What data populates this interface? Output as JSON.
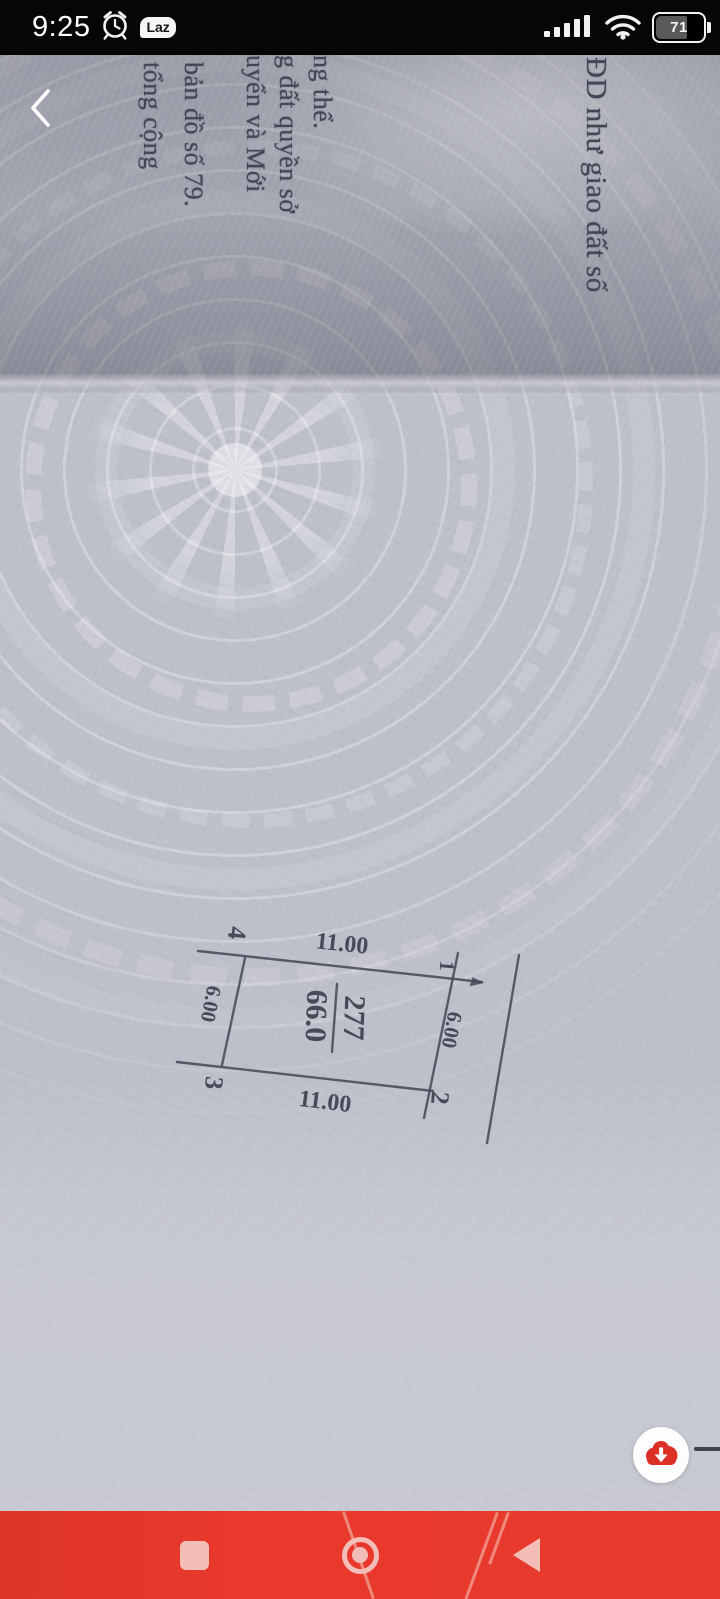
{
  "status_bar": {
    "time": "9:25",
    "laz_label": "Laz",
    "battery_percent": "71",
    "icons": [
      "alarm-icon",
      "lazada-notification-icon",
      "signal-icon",
      "wifi-icon",
      "battery-indicator"
    ]
  },
  "viewer": {
    "back_icon": "chevron-left",
    "download_icon": "cloud-download"
  },
  "document": {
    "lines": [
      "ĐD như giao đất số",
      "ng thể.",
      "g đất quyền sở",
      "uyển và Mới",
      "bản đồ số 79.",
      "tổng cộng"
    ],
    "parcel": {
      "number": "277",
      "area": "66.0",
      "top_length": "11.00",
      "bottom_length": "11.00",
      "left_length": "6.00",
      "right_length": "6.00",
      "v1": "1",
      "v2": "2",
      "v3": "3",
      "v4": "4"
    }
  },
  "nav_bar": {
    "recents_icon": "square",
    "home_icon": "circle",
    "back_icon": "triangle-left"
  },
  "colors": {
    "status_bar_bg": "#060607",
    "paper": "#bdbfca",
    "ink": "#434656",
    "nav_red": "#e73a2d",
    "nav_icon_pink": "#f3beb8",
    "fab_cloud_red": "#dc2f26",
    "fab_bg": "#fdfdfd"
  }
}
